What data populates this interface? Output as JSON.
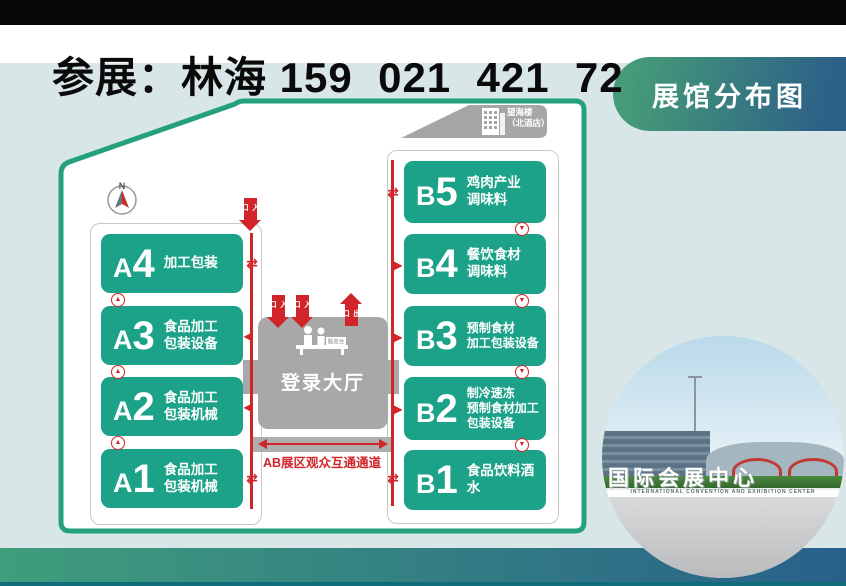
{
  "page": {
    "title_line": "参展：林海 159  021  421  72"
  },
  "badge": {
    "label": "展馆分布图"
  },
  "map": {
    "landmark": {
      "name_line1": "望海楼",
      "name_line2": "（北酒店）"
    },
    "compass_label": "N",
    "halls_a": [
      {
        "letter": "A",
        "digit": "4",
        "lines": [
          "加工包装"
        ]
      },
      {
        "letter": "A",
        "digit": "3",
        "lines": [
          "食品加工",
          "包装设备"
        ]
      },
      {
        "letter": "A",
        "digit": "2",
        "lines": [
          "食品加工",
          "包装机械"
        ]
      },
      {
        "letter": "A",
        "digit": "1",
        "lines": [
          "食品加工",
          "包装机械"
        ]
      }
    ],
    "halls_b": [
      {
        "letter": "B",
        "digit": "5",
        "lines": [
          "鸡肉产业",
          "调味料"
        ]
      },
      {
        "letter": "B",
        "digit": "4",
        "lines": [
          "餐饮食材",
          "调味料"
        ]
      },
      {
        "letter": "B",
        "digit": "3",
        "lines": [
          "预制食材",
          "加工包装设备"
        ]
      },
      {
        "letter": "B",
        "digit": "2",
        "lines": [
          "制冷速冻",
          "预制食材加工",
          "包装设备"
        ]
      },
      {
        "letter": "B",
        "digit": "1",
        "lines": [
          "食品饮料酒水"
        ]
      }
    ],
    "lobby": {
      "label": "登录大厅",
      "service_desk": "服务台",
      "entrance": "入口",
      "exit": "出口"
    },
    "corridor_label": "AB展区观众互通通道",
    "glyphs": {
      "up": "▲",
      "down": "▼",
      "exchange": "⇄",
      "left": "◀",
      "right": "▶"
    }
  },
  "photo": {
    "sign_cn": "国际会展中心",
    "sign_en": "INTERNATIONAL CONVENTION AND EXHIBITION CENTER"
  },
  "colors": {
    "hall_green": "#1ba288",
    "map_border_green": "#24a07d",
    "route_red": "#d0262a",
    "lobby_gray": "#a8a8a8",
    "background": "#d9e6e7",
    "pill_gradient_start": "#459a78",
    "pill_gradient_end": "#2d6187",
    "bottom_gradient_start": "#3f9e7c",
    "bottom_gradient_end": "#28608a"
  }
}
